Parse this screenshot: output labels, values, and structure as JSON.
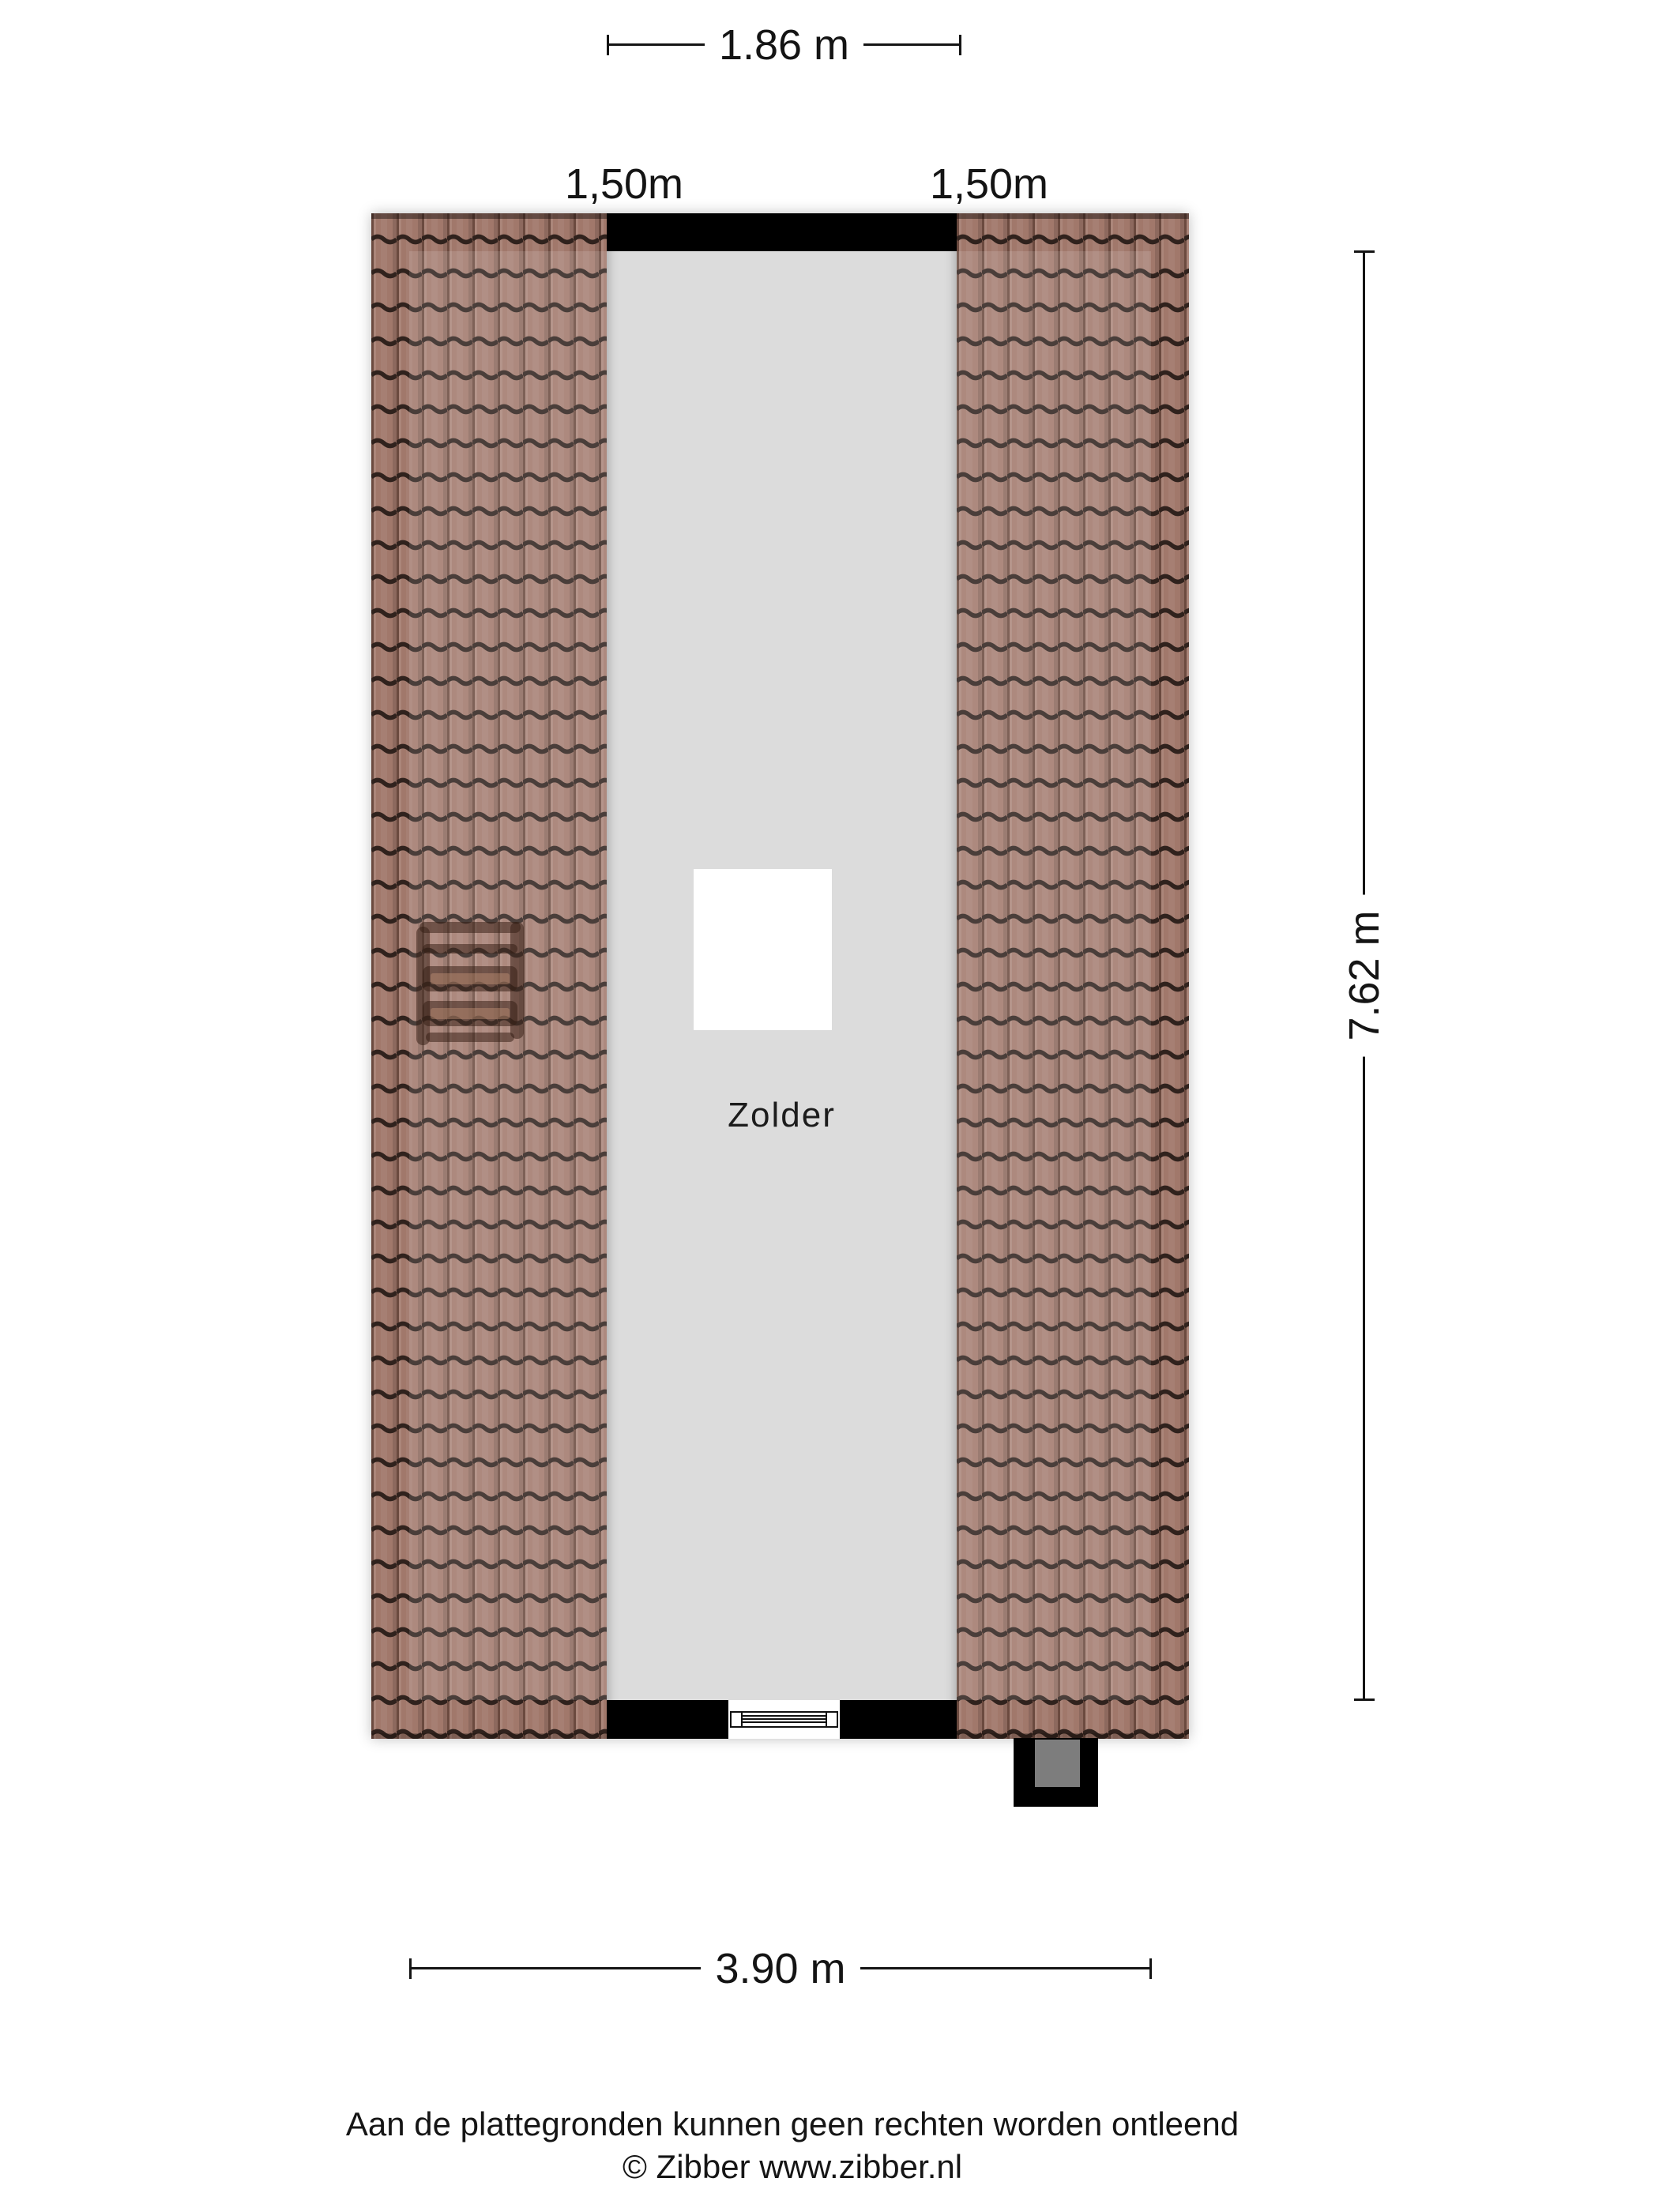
{
  "room": {
    "name": "Zolder"
  },
  "dimensions": {
    "top_width": {
      "label": "1.86 m"
    },
    "side_height": {
      "label": "7.62 m"
    },
    "bottom_width": {
      "label": "3.90 m"
    },
    "knee_left": {
      "label": "1,50m"
    },
    "knee_right": {
      "label": "1,50m"
    }
  },
  "footer": {
    "disclaimer": "Aan de plattegronden kunnen geen rechten worden ontleend",
    "copyright": "© Zibber www.zibber.nl"
  },
  "colors": {
    "page_background": "#ffffff",
    "tile_base": "#a1786b",
    "tile_edge": "#6b4a3f",
    "tile_line": "#30221d",
    "floor": "#d7d7d7",
    "wall": "#000000",
    "window_frame": "#111111",
    "chimney_inner": "#7d7d7d"
  }
}
